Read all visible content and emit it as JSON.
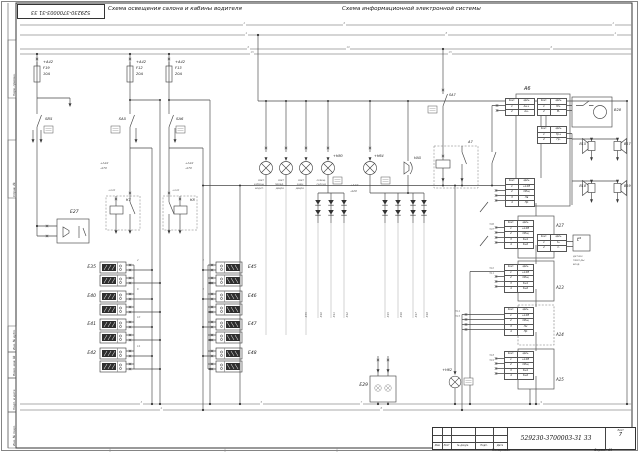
{
  "titles": {
    "left": "Схема освещения салона и кабины водителя",
    "right": "Схема информационной электронной системы"
  },
  "stamp": {
    "text": "529230-3700003-31 33"
  },
  "title_block": {
    "doc_number": "529230-3700003-31 33",
    "sheet_label": "Лист",
    "sheet_number": "7",
    "copied_label": "Копировал",
    "format_label": "Формат А3",
    "columns": [
      "Изм.",
      "Лист",
      "№ докум.",
      "Подп.",
      "Дата"
    ]
  },
  "conn_table_header": [
    "Конт.",
    "Цепь"
  ],
  "conn_tables": [
    {
      "n": "a6-t1",
      "x": 505,
      "y": 98,
      "rows": [
        [
          "1",
          "Ан+"
        ],
        [
          "2",
          "Ан-"
        ]
      ]
    },
    {
      "n": "a6-t2",
      "x": 537,
      "y": 98,
      "rows": [
        [
          "1",
          "М+"
        ],
        [
          "2",
          "М-"
        ]
      ]
    },
    {
      "n": "a6-t3",
      "x": 537,
      "y": 126,
      "rows": [
        [
          "1",
          "Гр+"
        ],
        [
          "2",
          "Гр-"
        ]
      ]
    },
    {
      "n": "a6-t4",
      "x": 505,
      "y": 178,
      "rows": [
        [
          "1",
          "+12В"
        ],
        [
          "2",
          "Общ"
        ],
        [
          "3",
          "Лв"
        ],
        [
          "4",
          "Пр"
        ]
      ]
    },
    {
      "n": "a17-t",
      "x": 504,
      "y": 220,
      "rows": [
        [
          "1",
          "+12В"
        ],
        [
          "2",
          "Общ"
        ],
        [
          "3",
          "Кн1"
        ],
        [
          "4",
          "Кн2"
        ]
      ]
    },
    {
      "n": "temp-t",
      "x": 537,
      "y": 234,
      "rows": [
        [
          "1",
          "t+"
        ],
        [
          "2",
          "t-"
        ]
      ]
    },
    {
      "n": "a13-t",
      "x": 504,
      "y": 264,
      "rows": [
        [
          "1",
          "+12В"
        ],
        [
          "2",
          "Общ"
        ],
        [
          "3",
          "Кн1"
        ],
        [
          "4",
          "Кн2"
        ]
      ]
    },
    {
      "n": "a14-t",
      "x": 504,
      "y": 307,
      "rows": [
        [
          "1",
          "+12В"
        ],
        [
          "2",
          "Общ"
        ],
        [
          "3",
          "Лн"
        ],
        [
          "4",
          "Пр"
        ]
      ]
    },
    {
      "n": "a15-t",
      "x": 504,
      "y": 351,
      "rows": [
        [
          "1",
          "+12В"
        ],
        [
          "2",
          "Общ"
        ],
        [
          "3",
          "Кн1"
        ],
        [
          "4",
          "Кн2"
        ]
      ]
    }
  ],
  "labels": [
    {
      "n": "fuse-f19-feed",
      "x": 43,
      "y": 61,
      "t": "+А42",
      "s": 3.6
    },
    {
      "n": "fuse-f19-name",
      "x": 43,
      "y": 67,
      "t": "F19",
      "s": 3.6
    },
    {
      "n": "fuse-f19-rating",
      "x": 43,
      "y": 73,
      "t": "10А",
      "s": 3.6
    },
    {
      "n": "fuse-f12-feed",
      "x": 136,
      "y": 61,
      "t": "+А42",
      "s": 3.6
    },
    {
      "n": "fuse-f12-name",
      "x": 136,
      "y": 67,
      "t": "F12",
      "s": 3.6
    },
    {
      "n": "fuse-f12-rating",
      "x": 136,
      "y": 73,
      "t": "20А",
      "s": 3.6
    },
    {
      "n": "fuse-f13-feed",
      "x": 175,
      "y": 61,
      "t": "+А42",
      "s": 3.6
    },
    {
      "n": "fuse-f13-name",
      "x": 175,
      "y": 67,
      "t": "F13",
      "s": 3.6
    },
    {
      "n": "fuse-f13-rating",
      "x": 175,
      "y": 73,
      "t": "20А",
      "s": 3.6
    },
    {
      "n": "switch-sb5-label",
      "x": 45,
      "y": 117,
      "t": "SB5",
      "s": 3.8
    },
    {
      "n": "switch-sa5-label",
      "x": 126,
      "y": 117,
      "t": "SA5",
      "s": 3.8,
      "a": "r"
    },
    {
      "n": "switch-sa6-label",
      "x": 176,
      "y": 117,
      "t": "SA6",
      "s": 3.8
    },
    {
      "n": "wire-left-1",
      "x": 100,
      "y": 162,
      "t": "+А42",
      "s": 3,
      "c": "#555"
    },
    {
      "n": "wire-left-2",
      "x": 100,
      "y": 167,
      "t": "-А70",
      "s": 3,
      "c": "#555"
    },
    {
      "n": "wire-right-1",
      "x": 185,
      "y": 162,
      "t": "+А42",
      "s": 3,
      "c": "#555"
    },
    {
      "n": "wire-right-2",
      "x": 185,
      "y": 167,
      "t": "-А70",
      "s": 3,
      "c": "#555"
    },
    {
      "n": "unit-e27-label",
      "x": 70,
      "y": 211,
      "t": "Е27",
      "s": 4.5
    },
    {
      "n": "relay-k7-label",
      "x": 126,
      "y": 199,
      "t": "К7",
      "s": 3.6
    },
    {
      "n": "relay-k8-label",
      "x": 190,
      "y": 199,
      "t": "К8",
      "s": 3.6
    },
    {
      "n": "relay-k7-wire",
      "x": 108,
      "y": 190,
      "t": "+А42",
      "s": 2.6,
      "c": "#777"
    },
    {
      "n": "relay-k8-wire",
      "x": 172,
      "y": 190,
      "t": "+А42",
      "s": 2.6,
      "c": "#777"
    },
    {
      "n": "module-e35-label",
      "x": 96,
      "y": 266,
      "t": "Е35",
      "s": 4.5,
      "a": "r"
    },
    {
      "n": "module-e40-label",
      "x": 96,
      "y": 295,
      "t": "Е40",
      "s": 4.5,
      "a": "r"
    },
    {
      "n": "module-e41-label",
      "x": 96,
      "y": 323,
      "t": "Е41",
      "s": 4.5,
      "a": "r"
    },
    {
      "n": "module-e42-label",
      "x": 96,
      "y": 352,
      "t": "Е42",
      "s": 4.5,
      "a": "r"
    },
    {
      "n": "module-e45-label",
      "x": 248,
      "y": 266,
      "t": "Е45",
      "s": 4.5
    },
    {
      "n": "module-e46-label",
      "x": 248,
      "y": 295,
      "t": "Е46",
      "s": 4.5
    },
    {
      "n": "module-e47-label",
      "x": 248,
      "y": 323,
      "t": "Е47",
      "s": 4.5
    },
    {
      "n": "module-e48-label",
      "x": 248,
      "y": 352,
      "t": "Е48",
      "s": 4.5
    },
    {
      "n": "lamp-h80-label",
      "x": 333,
      "y": 155,
      "t": "+Н80",
      "s": 3.4
    },
    {
      "n": "lamp-h64-label",
      "x": 374,
      "y": 155,
      "t": "+Н64",
      "s": 3.4
    },
    {
      "n": "lamp1-note-1",
      "x": 264,
      "y": 180,
      "t": "свет",
      "s": 2.6,
      "c": "#666",
      "a": "r"
    },
    {
      "n": "lamp1-note-2",
      "x": 264,
      "y": 184,
      "t": "кабины",
      "s": 2.6,
      "c": "#666",
      "a": "r"
    },
    {
      "n": "lamp1-note-3",
      "x": 264,
      "y": 188,
      "t": "водит.",
      "s": 2.6,
      "c": "#666",
      "a": "r"
    },
    {
      "n": "lamp2-note-1",
      "x": 284,
      "y": 180,
      "t": "свет",
      "s": 2.6,
      "c": "#666",
      "a": "r"
    },
    {
      "n": "lamp2-note-2",
      "x": 284,
      "y": 184,
      "t": "перед.",
      "s": 2.6,
      "c": "#666",
      "a": "r"
    },
    {
      "n": "lamp2-note-3",
      "x": 284,
      "y": 188,
      "t": "двери",
      "s": 2.6,
      "c": "#666",
      "a": "r"
    },
    {
      "n": "lamp3-note-1",
      "x": 304,
      "y": 180,
      "t": "свет",
      "s": 2.6,
      "c": "#666",
      "a": "r"
    },
    {
      "n": "lamp3-note-2",
      "x": 304,
      "y": 184,
      "t": "задн.",
      "s": 2.6,
      "c": "#666",
      "a": "r"
    },
    {
      "n": "lamp3-note-3",
      "x": 304,
      "y": 188,
      "t": "двери",
      "s": 2.6,
      "c": "#666",
      "a": "r"
    },
    {
      "n": "lamp4-note-1",
      "x": 326,
      "y": 180,
      "t": "освещ.",
      "s": 2.6,
      "c": "#666",
      "a": "r"
    },
    {
      "n": "lamp4-note-2",
      "x": 326,
      "y": 184,
      "t": "салона",
      "s": 2.6,
      "c": "#666",
      "a": "r"
    },
    {
      "n": "buzzer-ha5-label",
      "x": 414,
      "y": 157,
      "t": "НА5",
      "s": 3.4
    },
    {
      "n": "diode-feed-1",
      "x": 350,
      "y": 184,
      "t": "+А42",
      "s": 3,
      "c": "#555"
    },
    {
      "n": "diode-feed-2",
      "x": 350,
      "y": 190,
      "t": "-А20",
      "s": 3,
      "c": "#555"
    },
    {
      "n": "switch-sa7-label",
      "x": 449,
      "y": 94,
      "t": "SА7",
      "s": 3.4
    },
    {
      "n": "relay-a7-label",
      "x": 468,
      "y": 141,
      "t": "А7",
      "s": 3.6
    },
    {
      "n": "module-a6-label",
      "x": 524,
      "y": 87,
      "t": "А6",
      "s": 5
    },
    {
      "n": "device-b28-label",
      "x": 614,
      "y": 109,
      "t": "В28",
      "s": 3.6
    },
    {
      "n": "speaker-b15-label",
      "x": 586,
      "y": 143,
      "t": "В15",
      "s": 3.4,
      "a": "r"
    },
    {
      "n": "speaker-b17-label",
      "x": 624,
      "y": 143,
      "t": "В17",
      "s": 3.4
    },
    {
      "n": "speaker-b18-label",
      "x": 586,
      "y": 185,
      "t": "В18",
      "s": 3.4,
      "a": "r"
    },
    {
      "n": "speaker-b19-label",
      "x": 624,
      "y": 185,
      "t": "В19",
      "s": 3.4
    },
    {
      "n": "temp-sensor-symbol",
      "x": 577,
      "y": 238,
      "t": "t°",
      "s": 5
    },
    {
      "n": "temp-note-1",
      "x": 573,
      "y": 256,
      "t": "датчик",
      "s": 2.6,
      "c": "#666"
    },
    {
      "n": "temp-note-2",
      "x": 573,
      "y": 260,
      "t": "темп-ры",
      "s": 2.6,
      "c": "#666"
    },
    {
      "n": "temp-note-3",
      "x": 573,
      "y": 264,
      "t": "возд.",
      "s": 2.6,
      "c": "#666"
    },
    {
      "n": "module-a17-label",
      "x": 556,
      "y": 224,
      "t": "А17",
      "s": 4
    },
    {
      "n": "module-a13-label",
      "x": 556,
      "y": 286,
      "t": "А13",
      "s": 4
    },
    {
      "n": "module-a14-label",
      "x": 556,
      "y": 333,
      "t": "А14",
      "s": 4
    },
    {
      "n": "module-a15-label",
      "x": 556,
      "y": 378,
      "t": "А15",
      "s": 4
    },
    {
      "n": "unit-e29-label",
      "x": 368,
      "y": 384,
      "t": "Е29",
      "s": 4.5,
      "a": "r"
    },
    {
      "n": "lamp-h62-label",
      "x": 452,
      "y": 369,
      "t": "+Н62",
      "s": 3.4,
      "a": "r"
    },
    {
      "n": "wire-e35",
      "x": 306,
      "y": 318,
      "t": "-Е35",
      "s": 2.6,
      "c": "#666",
      "r": -90
    },
    {
      "n": "wire-e40",
      "x": 321,
      "y": 318,
      "t": "-Е40",
      "s": 2.6,
      "c": "#666",
      "r": -90
    },
    {
      "n": "wire-e41",
      "x": 334,
      "y": 318,
      "t": "-Е41",
      "s": 2.6,
      "c": "#666",
      "r": -90
    },
    {
      "n": "wire-e42",
      "x": 347,
      "y": 318,
      "t": "-Е42",
      "s": 2.6,
      "c": "#666",
      "r": -90
    },
    {
      "n": "wire-e45",
      "x": 388,
      "y": 318,
      "t": "-Е45",
      "s": 2.6,
      "c": "#666",
      "r": -90
    },
    {
      "n": "wire-e46",
      "x": 401,
      "y": 318,
      "t": "-Е46",
      "s": 2.6,
      "c": "#666",
      "r": -90
    },
    {
      "n": "wire-e47",
      "x": 416,
      "y": 318,
      "t": "-Е47",
      "s": 2.6,
      "c": "#666",
      "r": -90
    },
    {
      "n": "wire-e48",
      "x": 427,
      "y": 318,
      "t": "-Е48",
      "s": 2.6,
      "c": "#666",
      "r": -90
    },
    {
      "n": "bus-num",
      "x": 243,
      "y": 23,
      "t": "2",
      "s": 2.6,
      "c": "#888",
      "bg": 1
    },
    {
      "n": "bus-num",
      "x": 343,
      "y": 23,
      "t": "6",
      "s": 2.6,
      "c": "#888",
      "bg": 1
    },
    {
      "n": "bus-num",
      "x": 612,
      "y": 23,
      "t": "2",
      "s": 2.6,
      "c": "#888",
      "bg": 1
    },
    {
      "n": "bus-num",
      "x": 245,
      "y": 33,
      "t": "4",
      "s": 2.6,
      "c": "#888",
      "bg": 1
    },
    {
      "n": "bus-num",
      "x": 445,
      "y": 33,
      "t": "8",
      "s": 2.6,
      "c": "#888",
      "bg": 1
    },
    {
      "n": "bus-num",
      "x": 614,
      "y": 33,
      "t": "4",
      "s": 2.6,
      "c": "#888",
      "bg": 1
    },
    {
      "n": "bus-num",
      "x": 247,
      "y": 47,
      "t": "6",
      "s": 2.6,
      "c": "#888",
      "bg": 1
    },
    {
      "n": "bus-num",
      "x": 346,
      "y": 47,
      "t": "10",
      "s": 2.6,
      "c": "#888",
      "bg": 1
    },
    {
      "n": "bus-num",
      "x": 550,
      "y": 47,
      "t": "6",
      "s": 2.6,
      "c": "#888",
      "bg": 1
    },
    {
      "n": "bus-num",
      "x": 250,
      "y": 52,
      "t": "15",
      "s": 2.6,
      "c": "#888",
      "bg": 1
    },
    {
      "n": "bus-num",
      "x": 448,
      "y": 52,
      "t": "15",
      "s": 2.6,
      "c": "#888",
      "bg": 1
    },
    {
      "n": "bus-num",
      "x": 140,
      "y": 402,
      "t": "3",
      "s": 2.6,
      "c": "#888",
      "bg": 1
    },
    {
      "n": "bus-num",
      "x": 260,
      "y": 402,
      "t": "5",
      "s": 2.6,
      "c": "#888",
      "bg": 1
    },
    {
      "n": "bus-num",
      "x": 360,
      "y": 402,
      "t": "7",
      "s": 2.6,
      "c": "#888",
      "bg": 1
    },
    {
      "n": "bus-num",
      "x": 540,
      "y": 402,
      "t": "9",
      "s": 2.6,
      "c": "#888",
      "bg": 1
    },
    {
      "n": "bus-num",
      "x": 160,
      "y": 408,
      "t": "4",
      "s": 2.6,
      "c": "#888",
      "bg": 1
    },
    {
      "n": "bus-num",
      "x": 380,
      "y": 408,
      "t": "8",
      "s": 2.6,
      "c": "#888",
      "bg": 1
    },
    {
      "n": "stub-num",
      "x": 137,
      "y": 260,
      "t": "2",
      "s": 2.6,
      "c": "#777"
    },
    {
      "n": "stub-num",
      "x": 137,
      "y": 289,
      "t": "6",
      "s": 2.6,
      "c": "#777"
    },
    {
      "n": "stub-num",
      "x": 137,
      "y": 317,
      "t": "10",
      "s": 2.6,
      "c": "#777"
    },
    {
      "n": "stub-num",
      "x": 137,
      "y": 346,
      "t": "14",
      "s": 2.6,
      "c": "#777"
    },
    {
      "n": "stub-num",
      "x": 204,
      "y": 260,
      "t": "4",
      "s": 2.6,
      "c": "#777",
      "a": "r"
    },
    {
      "n": "stub-num",
      "x": 204,
      "y": 289,
      "t": "8",
      "s": 2.6,
      "c": "#777",
      "a": "r"
    },
    {
      "n": "wire-num",
      "x": 494,
      "y": 224,
      "t": "506",
      "s": 2.4,
      "c": "#777",
      "a": "r"
    },
    {
      "n": "wire-num",
      "x": 494,
      "y": 229,
      "t": "507",
      "s": 2.4,
      "c": "#777",
      "a": "r"
    },
    {
      "n": "wire-num",
      "x": 494,
      "y": 268,
      "t": "510",
      "s": 2.4,
      "c": "#777",
      "a": "r"
    },
    {
      "n": "wire-num",
      "x": 494,
      "y": 273,
      "t": "511",
      "s": 2.4,
      "c": "#777",
      "a": "r"
    },
    {
      "n": "wire-num",
      "x": 460,
      "y": 311,
      "t": "514",
      "s": 2.4,
      "c": "#777",
      "a": "r"
    },
    {
      "n": "wire-num",
      "x": 460,
      "y": 316,
      "t": "515",
      "s": 2.4,
      "c": "#777",
      "a": "r"
    },
    {
      "n": "wire-num",
      "x": 494,
      "y": 355,
      "t": "518",
      "s": 2.4,
      "c": "#777",
      "a": "r"
    },
    {
      "n": "wire-num",
      "x": 494,
      "y": 360,
      "t": "519",
      "s": 2.4,
      "c": "#777",
      "a": "r"
    },
    {
      "n": "margin-field",
      "x": 13,
      "y": 96,
      "t": "Перв. примен.",
      "s": 3,
      "c": "#333",
      "r": -90
    },
    {
      "n": "margin-field",
      "x": 13,
      "y": 197,
      "t": "Справ. №",
      "s": 3,
      "c": "#333",
      "r": -90
    },
    {
      "n": "margin-field",
      "x": 13,
      "y": 350,
      "t": "Инв. № дубл.",
      "s": 3,
      "c": "#333",
      "r": -90
    },
    {
      "n": "margin-field",
      "x": 13,
      "y": 376,
      "t": "Взам. инв. №",
      "s": 3,
      "c": "#333",
      "r": -90
    },
    {
      "n": "margin-field",
      "x": 13,
      "y": 410,
      "t": "Подп. и дата",
      "s": 3,
      "c": "#333",
      "r": -90
    },
    {
      "n": "margin-field",
      "x": 13,
      "y": 446,
      "t": "Инв. № подл.",
      "s": 3,
      "c": "#333",
      "r": -90
    }
  ]
}
